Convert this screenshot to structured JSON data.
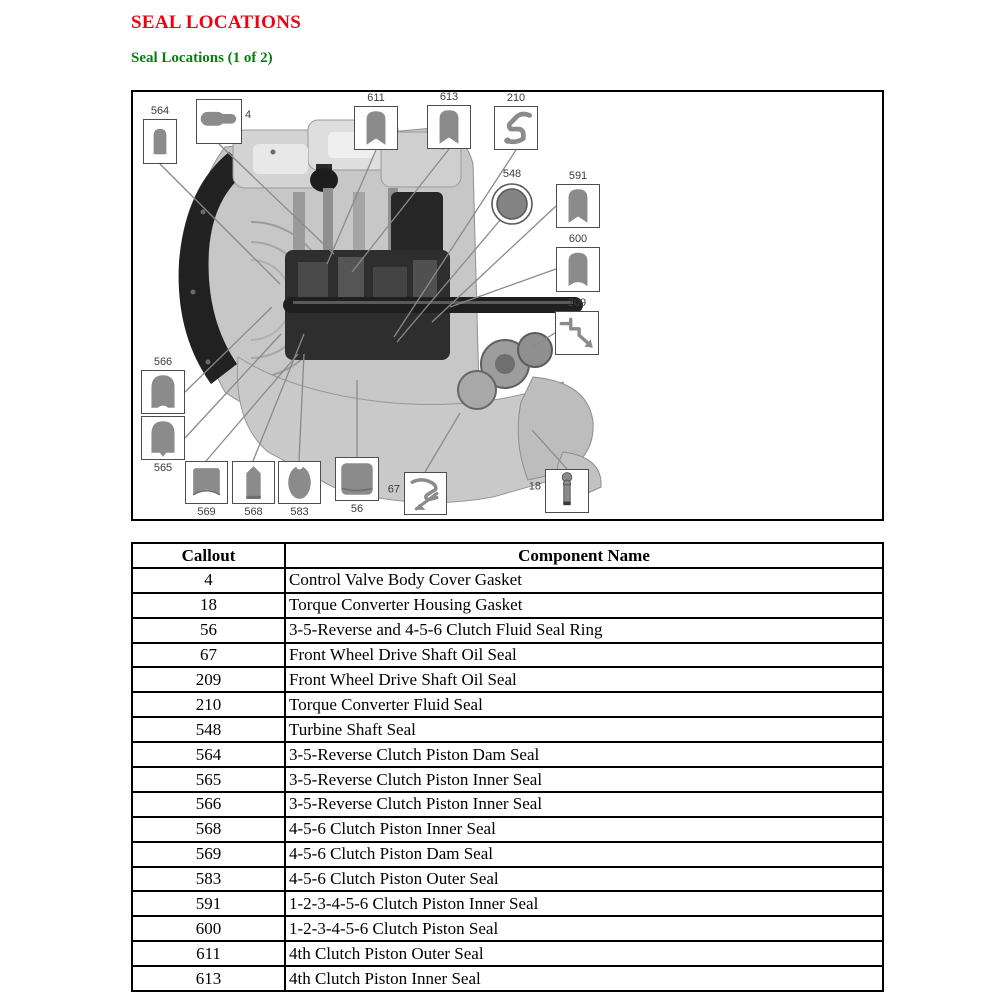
{
  "page": {
    "title": "SEAL LOCATIONS",
    "subtitle": "Seal Locations (1 of 2)"
  },
  "colors": {
    "title_red": "#f00012",
    "subtitle_green": "#0b7c12",
    "seal_fill": "#8b8b8b",
    "callout_box_border": "#4d4d4d",
    "leader_line_gray": "#8a8a8a",
    "table_border": "#000000"
  },
  "figure": {
    "description": "Cutaway illustration of automatic transaxle with numbered seal callouts",
    "callouts": [
      {
        "label": "564",
        "icon": "bullet-seal"
      },
      {
        "label": "4",
        "icon": "horizontal-gasket"
      },
      {
        "label": "611",
        "icon": "bullet-notch-seal"
      },
      {
        "label": "613",
        "icon": "bullet-notch-seal"
      },
      {
        "label": "210",
        "icon": "s-profile-seal"
      },
      {
        "label": "548",
        "icon": "ring-seal"
      },
      {
        "label": "591",
        "icon": "bullet-notch-seal"
      },
      {
        "label": "600",
        "icon": "bullet-curve-notch-seal"
      },
      {
        "label": "209",
        "icon": "zigzag-profile-seal"
      },
      {
        "label": "566",
        "icon": "dome-seal"
      },
      {
        "label": "565",
        "icon": "dome-point-seal"
      },
      {
        "label": "569",
        "icon": "dam-seal"
      },
      {
        "label": "568",
        "icon": "pointed-seal"
      },
      {
        "label": "583",
        "icon": "oval-seal"
      },
      {
        "label": "56",
        "icon": "square-seal-ring"
      },
      {
        "label": "67",
        "icon": "lip-profile-seal"
      },
      {
        "label": "18",
        "icon": "stud-gasket"
      }
    ]
  },
  "table": {
    "headers": [
      "Callout",
      "Component Name"
    ],
    "rows": [
      {
        "callout": "4",
        "name": "Control Valve Body Cover Gasket"
      },
      {
        "callout": "18",
        "name": "Torque Converter Housing Gasket"
      },
      {
        "callout": "56",
        "name": "3-5-Reverse and 4-5-6 Clutch Fluid Seal Ring"
      },
      {
        "callout": "67",
        "name": "Front Wheel Drive Shaft Oil Seal"
      },
      {
        "callout": "209",
        "name": "Front Wheel Drive Shaft Oil Seal"
      },
      {
        "callout": "210",
        "name": "Torque Converter Fluid Seal"
      },
      {
        "callout": "548",
        "name": "Turbine Shaft Seal"
      },
      {
        "callout": "564",
        "name": "3-5-Reverse Clutch Piston Dam Seal"
      },
      {
        "callout": "565",
        "name": "3-5-Reverse Clutch Piston Inner Seal"
      },
      {
        "callout": "566",
        "name": "3-5-Reverse Clutch Piston Inner Seal"
      },
      {
        "callout": "568",
        "name": "4-5-6 Clutch Piston Inner Seal"
      },
      {
        "callout": "569",
        "name": "4-5-6 Clutch Piston Dam Seal"
      },
      {
        "callout": "583",
        "name": "4-5-6 Clutch Piston Outer Seal"
      },
      {
        "callout": "591",
        "name": "1-2-3-4-5-6 Clutch Piston Inner Seal"
      },
      {
        "callout": "600",
        "name": "1-2-3-4-5-6 Clutch Piston Seal"
      },
      {
        "callout": "611",
        "name": "4th Clutch Piston Outer Seal"
      },
      {
        "callout": "613",
        "name": "4th Clutch Piston Inner Seal"
      }
    ]
  }
}
